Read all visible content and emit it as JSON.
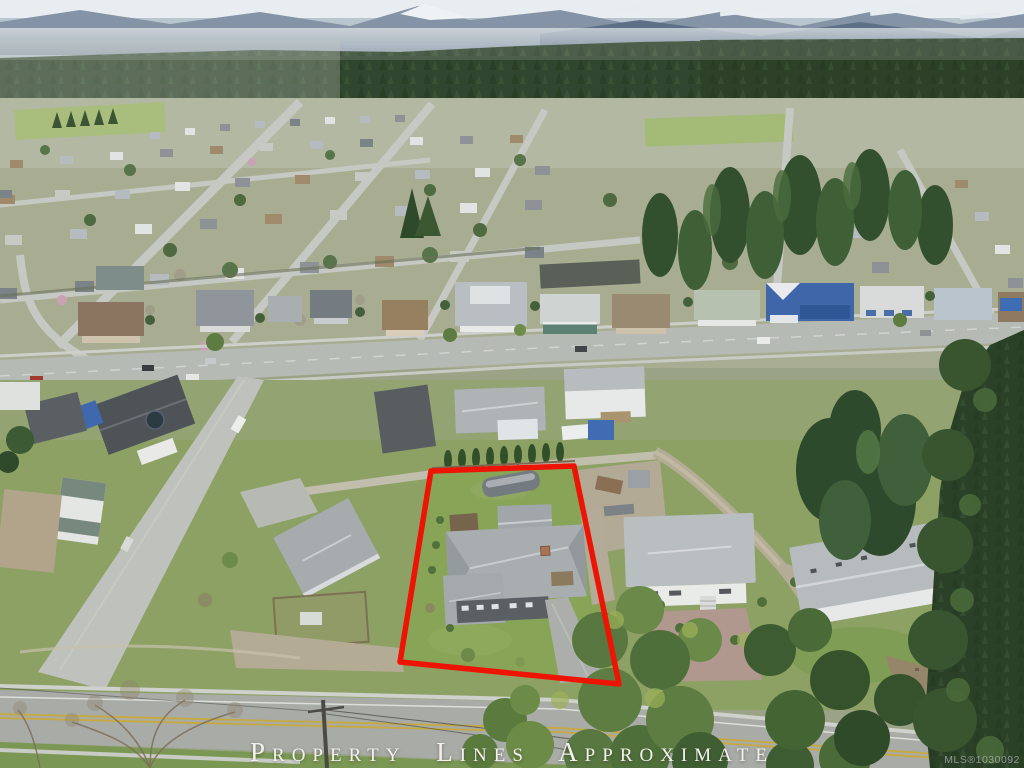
{
  "scene": {
    "description": "Aerial drone photo of a suburban neighbourhood backed by forested hills and snow-capped mountains; a single-family lot with grey-roofed house, detached garage, covered boat and driveway is outlined in red"
  },
  "overlay": {
    "caption": "Property Lines Approximate",
    "watermark": "MLS®1030092"
  },
  "colors": {
    "outline_red": "#ee1405",
    "caption_text": "#f3f1ec",
    "watermark_text": "#cdced2",
    "sky": "#b9c6cf",
    "mountains": "#8494a6",
    "snow": "#e8edf2",
    "forest": "#31462e",
    "grass": "#87a457",
    "road": "#aeb1ac",
    "roof_gray": "#a8adb0"
  }
}
